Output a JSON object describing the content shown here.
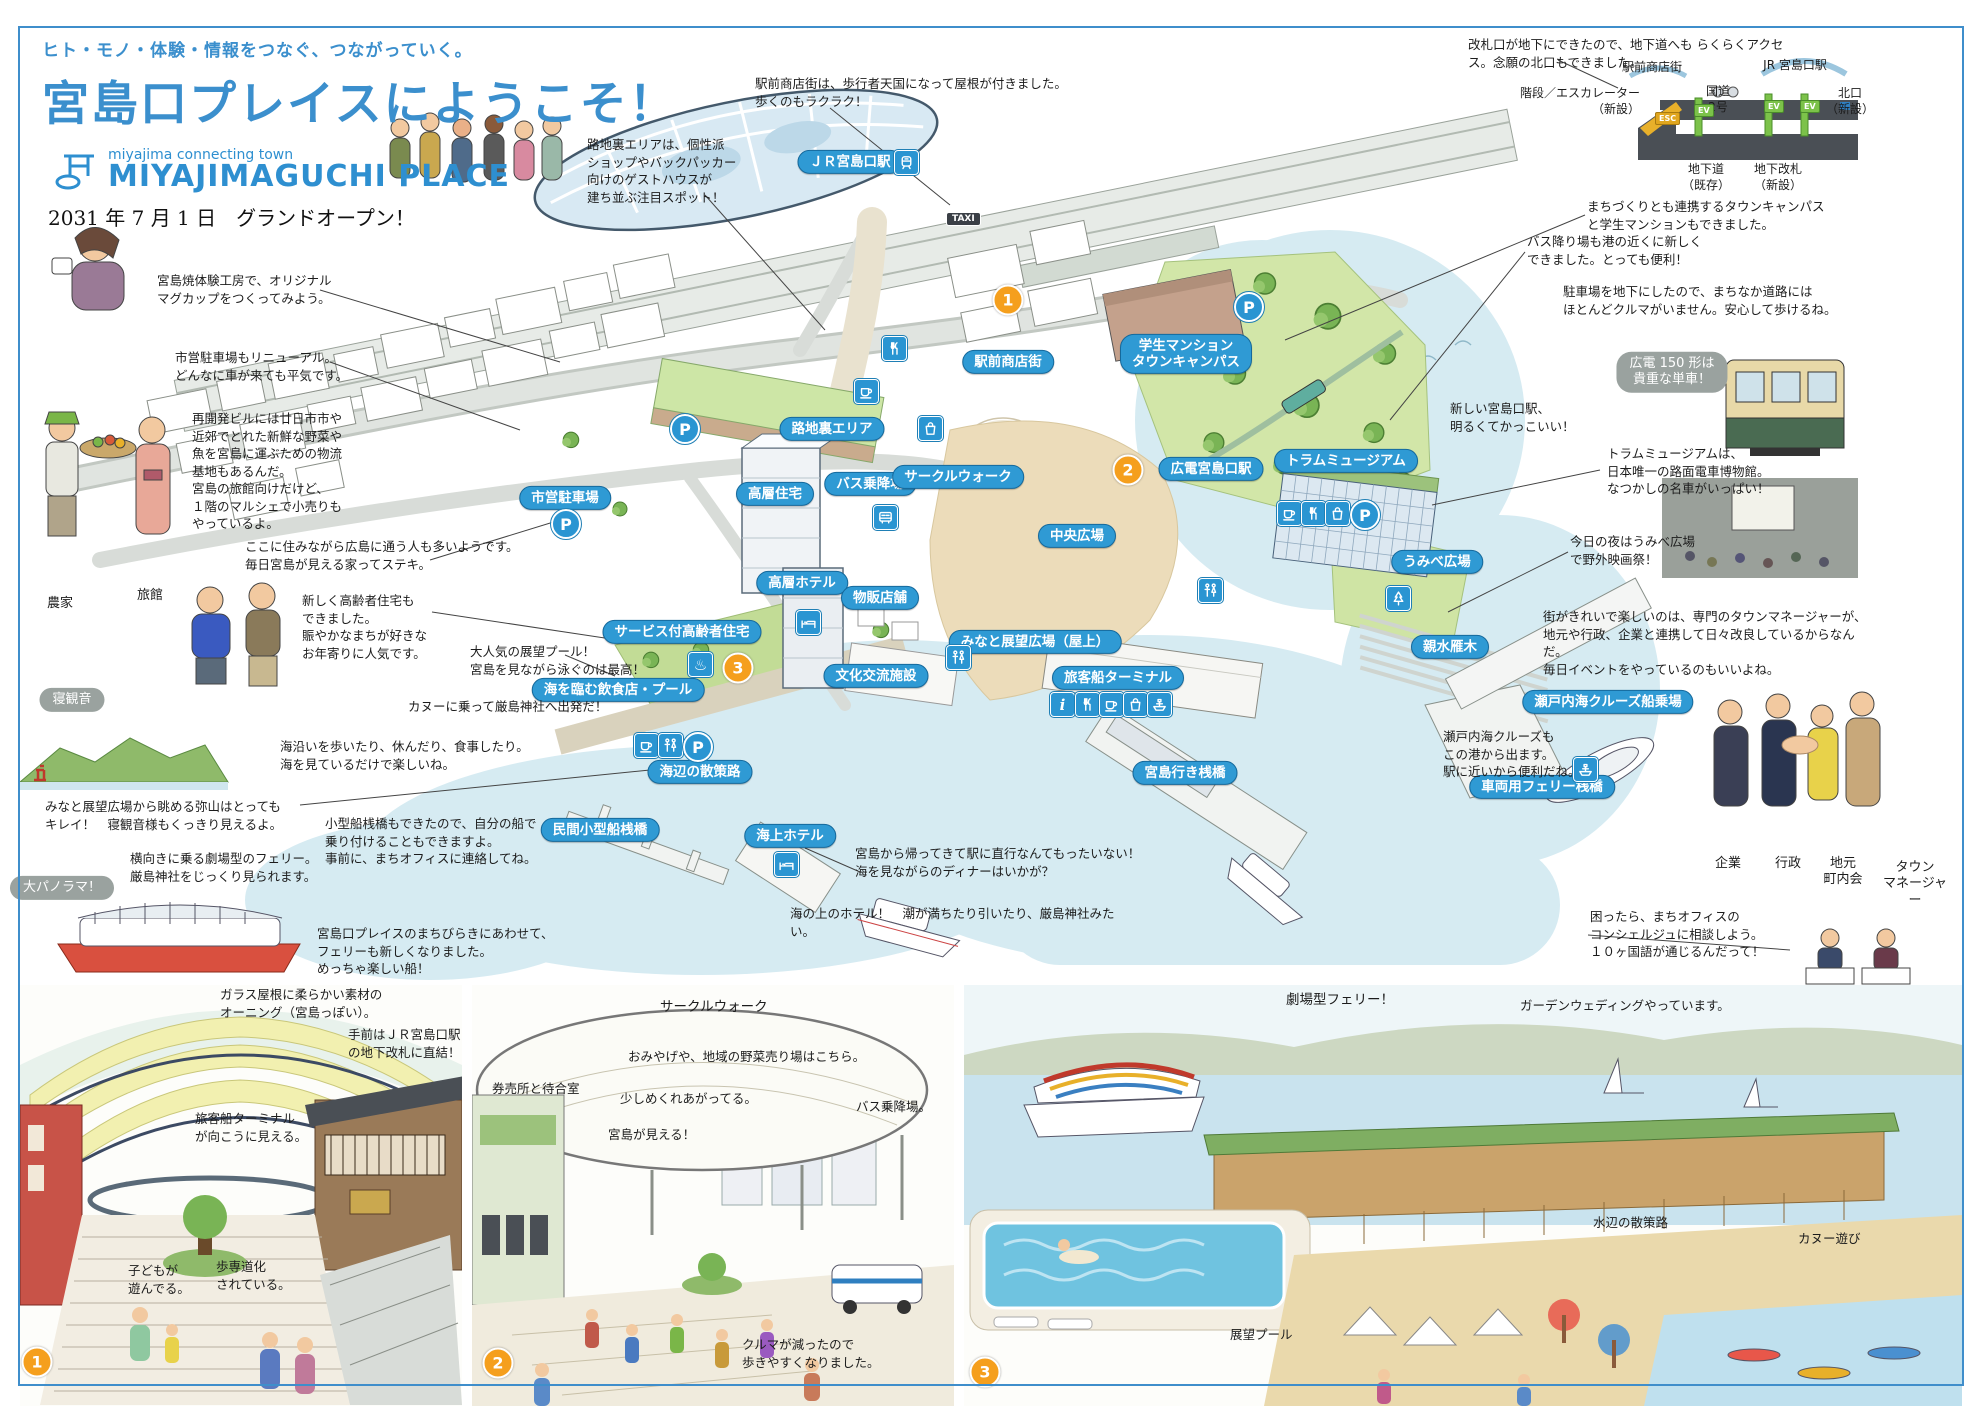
{
  "header": {
    "tagline": "ヒト・モノ・体験・情報をつなぐ、つながっていく。",
    "title": "宮島口プレイスにようこそ！",
    "logo_sub": "miyajima connecting town",
    "logo_main": "MIYAJIMAGUCHI PLACE",
    "open_date": "2031 年 7 月 1 日　グランドオープン！"
  },
  "colors": {
    "accent": "#3b8fcd",
    "pill": "#2f9ad4",
    "water": "#d6ebf2",
    "badge": "#f59f1d",
    "bubble": "#9aa29f"
  },
  "map": {
    "pills": [
      {
        "t": "ＪＲ宮島口駅",
        "x": 850,
        "y": 162
      },
      {
        "t": "駅前商店街",
        "x": 1008,
        "y": 362
      },
      {
        "t": "路地裏エリア",
        "x": 832,
        "y": 429
      },
      {
        "t": "市営駐車場",
        "x": 565,
        "y": 498
      },
      {
        "t": "バス乗降場",
        "x": 870,
        "y": 484
      },
      {
        "t": "サークルウォーク",
        "x": 958,
        "y": 477
      },
      {
        "t": "高層住宅",
        "x": 775,
        "y": 494
      },
      {
        "t": "高層ホテル",
        "x": 802,
        "y": 583
      },
      {
        "t": "物販店舗",
        "x": 880,
        "y": 598
      },
      {
        "t": "サービス付高齢者住宅",
        "x": 682,
        "y": 632
      },
      {
        "t": "文化交流施設",
        "x": 876,
        "y": 676
      },
      {
        "t": "みなと展望広場（屋上）",
        "x": 1035,
        "y": 642
      },
      {
        "t": "中央広場",
        "x": 1077,
        "y": 536
      },
      {
        "t": "広電宮島口駅",
        "x": 1211,
        "y": 469
      },
      {
        "t": "学生マンション\nタウンキャンパス",
        "x": 1186,
        "y": 354
      },
      {
        "t": "トラムミュージアム",
        "x": 1346,
        "y": 461
      },
      {
        "t": "うみべ広場",
        "x": 1437,
        "y": 562
      },
      {
        "t": "親水雁木",
        "x": 1450,
        "y": 647
      },
      {
        "t": "瀬戸内海クルーズ船乗場",
        "x": 1608,
        "y": 702
      },
      {
        "t": "車両用フェリー桟橋",
        "x": 1542,
        "y": 787
      },
      {
        "t": "旅客船ターミナル",
        "x": 1118,
        "y": 678
      },
      {
        "t": "宮島行き桟橋",
        "x": 1185,
        "y": 773
      },
      {
        "t": "民間小型船桟橋",
        "x": 600,
        "y": 830
      },
      {
        "t": "海上ホテル",
        "x": 790,
        "y": 836
      },
      {
        "t": "海辺の散策路",
        "x": 700,
        "y": 772
      },
      {
        "t": "海を臨む飲食店・プール",
        "x": 618,
        "y": 690
      }
    ],
    "badges": [
      {
        "t": "1",
        "x": 1008,
        "y": 300
      },
      {
        "t": "2",
        "x": 1128,
        "y": 470
      },
      {
        "t": "3",
        "x": 738,
        "y": 668
      }
    ],
    "callouts": [
      {
        "t": "駅前商店街は、歩行者天国になって屋根が付きました。\n歩くのもラクラク！",
        "x": 755,
        "y": 75
      },
      {
        "t": "路地裏エリアは、個性派\nショップやバックパッカー\n向けのゲストハウスが\n建ち並ぶ注目スポット！",
        "x": 587,
        "y": 136
      },
      {
        "t": "宮島焼体験工房で、オリジナル\nマグカップをつくってみよう。",
        "x": 157,
        "y": 272
      },
      {
        "t": "市営駐車場もリニューアル。\nどんなに車が来ても平気です。",
        "x": 175,
        "y": 349
      },
      {
        "t": "再開発ビルには廿日市市や\n近郊でとれた新鮮な野菜や\n魚を宮島に運ぶための物流\n基地もあるんだ。\n宮島の旅館向けだけど、\n１階のマルシェで小売りも\nやっているよ。",
        "x": 192,
        "y": 410
      },
      {
        "t": "ここに住みながら広島に通う人も多いようです。\n毎日宮島が見える家ってステキ。",
        "x": 245,
        "y": 538
      },
      {
        "t": "新しく高齢者住宅も\nできました。\n賑やかなまちが好きな\nお年寄りに人気です。",
        "x": 302,
        "y": 592
      },
      {
        "t": "大人気の展望プール！\n宮島を見ながら泳ぐのは最高！",
        "x": 470,
        "y": 643
      },
      {
        "t": "カヌーに乗って厳島神社へ出発だ！",
        "x": 408,
        "y": 698
      },
      {
        "t": "海沿いを歩いたり、休んだり、食事したり。\n海を見ているだけで楽しいね。",
        "x": 280,
        "y": 738
      },
      {
        "t": "みなと展望広場から眺める弥山はとっても\nキレイ！　寝観音様もくっきり見えるよ。",
        "x": 45,
        "y": 798
      },
      {
        "t": "小型船桟橋もできたので、自分の船で\n乗り付けることもできますよ。\n事前に、まちオフィスに連絡してね。",
        "x": 325,
        "y": 815
      },
      {
        "t": "横向きに乗る劇場型のフェリー。\n厳島神社をじっくり見られます。",
        "x": 130,
        "y": 850
      },
      {
        "t": "宮島口プレイスのまちびらきにあわせて、\nフェリーも新しくなりました。\nめっちゃ楽しい船！",
        "x": 317,
        "y": 925
      },
      {
        "t": "宮島から帰ってきて駅に直行なんてもったいない！\n海を見ながらのディナーはいかが？",
        "x": 855,
        "y": 845
      },
      {
        "t": "海の上のホテル！　潮が満ちたり引いたり、厳島神社みたい。",
        "x": 790,
        "y": 905
      },
      {
        "t": "改札口が地下にできたので、地下道へも らくらくアクセス。念願の北口もできました。",
        "x": 1468,
        "y": 36
      },
      {
        "t": "まちづくりとも連携するタウンキャンパス\nと学生マンションもできました。",
        "x": 1587,
        "y": 198
      },
      {
        "t": "バス降り場も港の近くに新しく\nできました。とっても便利！",
        "x": 1527,
        "y": 233
      },
      {
        "t": "駐車場を地下にしたので、まちなか道路には\nほとんどクルマがいません。安心して歩けるね。",
        "x": 1563,
        "y": 283
      },
      {
        "t": "新しい宮島口駅、\n明るくてかっこいい！",
        "x": 1450,
        "y": 400
      },
      {
        "t": "トラムミュージアムは、\n日本唯一の路面電車博物館。\nなつかしの名車がいっぱい！",
        "x": 1607,
        "y": 445
      },
      {
        "t": "今日の夜はうみべ広場\nで野外映画祭！",
        "x": 1570,
        "y": 533
      },
      {
        "t": "街がきれいで楽しいのは、専門のタウンマネージャーが、\n地元や行政、企業と連携して日々改良しているからなんだ。\n毎日イベントをやっているのもいいよね。",
        "x": 1543,
        "y": 608
      },
      {
        "t": "瀬戸内海クルーズも\nこの港から出ます。\n駅に近いから便利だね。",
        "x": 1443,
        "y": 728
      },
      {
        "t": "困ったら、まちオフィスの\nコンシェルジュに相談しよう。\n１０ヶ国語が通じるんだって！",
        "x": 1590,
        "y": 908
      }
    ],
    "bubbles": [
      {
        "t": "寝観音",
        "x": 72,
        "y": 700
      },
      {
        "t": "大パノラマ！",
        "x": 62,
        "y": 888
      },
      {
        "t": "広電 150 形は\n貴重な単車！",
        "x": 1672,
        "y": 372
      }
    ],
    "person_labels": [
      {
        "t": "農家",
        "x": 60,
        "y": 596
      },
      {
        "t": "旅館",
        "x": 150,
        "y": 588
      },
      {
        "t": "企業",
        "x": 1728,
        "y": 856
      },
      {
        "t": "行政",
        "x": 1788,
        "y": 856
      },
      {
        "t": "地元\n町内会",
        "x": 1843,
        "y": 856
      },
      {
        "t": "タウン\nマネージャー",
        "x": 1915,
        "y": 860
      }
    ],
    "icons": [
      {
        "g": "train",
        "x": 894,
        "y": 150
      },
      {
        "g": "taxi",
        "x": 946,
        "y": 212,
        "t": "TAXI"
      },
      {
        "g": "fork",
        "x": 882,
        "y": 336
      },
      {
        "g": "cup",
        "x": 854,
        "y": 379
      },
      {
        "g": "bag",
        "x": 918,
        "y": 416
      },
      {
        "g": "p",
        "x": 670,
        "y": 414
      },
      {
        "g": "p",
        "x": 551,
        "y": 509
      },
      {
        "g": "p",
        "x": 1234,
        "y": 292
      },
      {
        "g": "bus",
        "x": 873,
        "y": 505
      },
      {
        "g": "onsen",
        "x": 688,
        "y": 652,
        "t": "♨"
      },
      {
        "g": "bed",
        "x": 796,
        "y": 610
      },
      {
        "g": "wc",
        "x": 946,
        "y": 645
      },
      {
        "g": "wc",
        "x": 1198,
        "y": 578
      },
      {
        "g": "cup",
        "x": 1277,
        "y": 501
      },
      {
        "g": "fork",
        "x": 1301,
        "y": 501
      },
      {
        "g": "bag",
        "x": 1325,
        "y": 501
      },
      {
        "g": "p",
        "x": 1350,
        "y": 500
      },
      {
        "g": "tree",
        "x": 1386,
        "y": 586
      },
      {
        "g": "info",
        "x": 1050,
        "y": 692,
        "t": "i"
      },
      {
        "g": "fork",
        "x": 1075,
        "y": 692
      },
      {
        "g": "cup",
        "x": 1099,
        "y": 692
      },
      {
        "g": "bag",
        "x": 1123,
        "y": 692
      },
      {
        "g": "ship",
        "x": 1147,
        "y": 692
      },
      {
        "g": "ship",
        "x": 1573,
        "y": 757
      },
      {
        "g": "cup",
        "x": 634,
        "y": 733
      },
      {
        "g": "wc",
        "x": 658,
        "y": 733
      },
      {
        "g": "p",
        "x": 683,
        "y": 732
      },
      {
        "g": "bed",
        "x": 774,
        "y": 852
      }
    ]
  },
  "section_diagram": {
    "labels": [
      {
        "t": "駅前商店街",
        "x": 1652,
        "y": 60,
        "a": "c"
      },
      {
        "t": "国道\n2号",
        "x": 1718,
        "y": 84,
        "a": "c"
      },
      {
        "t": "JR 宮島口駅",
        "x": 1795,
        "y": 58,
        "a": "c"
      },
      {
        "t": "階段／エスカレーター\n（新設）",
        "x": 1640,
        "y": 86,
        "a": "r"
      },
      {
        "t": "北口\n（新設）",
        "x": 1850,
        "y": 86,
        "a": "c"
      },
      {
        "t": "地下道\n（既存）",
        "x": 1706,
        "y": 162,
        "a": "c"
      },
      {
        "t": "地下改札\n（新設）",
        "x": 1778,
        "y": 162,
        "a": "c"
      }
    ],
    "tags": [
      {
        "t": "ESC",
        "x": 1655,
        "y": 112,
        "cls": "esc"
      },
      {
        "t": "EV",
        "x": 1694,
        "y": 104,
        "cls": "ev"
      },
      {
        "t": "EV",
        "x": 1764,
        "y": 100,
        "cls": "ev"
      },
      {
        "t": "EV",
        "x": 1800,
        "y": 100,
        "cls": "ev"
      }
    ]
  },
  "panels": {
    "badges": [
      {
        "t": "1",
        "x": 37,
        "y": 1362
      },
      {
        "t": "2",
        "x": 498,
        "y": 1363
      },
      {
        "t": "3",
        "x": 985,
        "y": 1372
      }
    ],
    "texts": [
      {
        "t": "ガラス屋根に柔らかい素材の\nオーニング（宮島っぽい）。",
        "x": 220,
        "y": 986
      },
      {
        "t": "手前はＪＲ宮島口駅\nの地下改札に直結！",
        "x": 348,
        "y": 1026
      },
      {
        "t": "旅客船ターミナル\nが向こうに見える。",
        "x": 195,
        "y": 1110
      },
      {
        "t": "子どもが\n遊んでる。",
        "x": 128,
        "y": 1262
      },
      {
        "t": "歩専道化\nされている。",
        "x": 216,
        "y": 1258
      },
      {
        "t": "サークルウォーク",
        "x": 660,
        "y": 998,
        "cls": "big"
      },
      {
        "t": "券売所と待合室",
        "x": 492,
        "y": 1080
      },
      {
        "t": "おみやげや、地域の野菜売り場はこちら。",
        "x": 628,
        "y": 1048
      },
      {
        "t": "少しめくれあがってる。",
        "x": 620,
        "y": 1090
      },
      {
        "t": "宮島が見える！",
        "x": 608,
        "y": 1126
      },
      {
        "t": "バス乗降場。",
        "x": 856,
        "y": 1098
      },
      {
        "t": "クルマが減ったので\n歩きやすくなりました。",
        "x": 742,
        "y": 1336
      },
      {
        "t": "劇場型フェリー！",
        "x": 1286,
        "y": 991,
        "cls": "big"
      },
      {
        "t": "ガーデンウェディングやっています。",
        "x": 1520,
        "y": 997
      },
      {
        "t": "水辺の散策路",
        "x": 1593,
        "y": 1214
      },
      {
        "t": "カヌー遊び",
        "x": 1798,
        "y": 1230
      },
      {
        "t": "展望プール",
        "x": 1230,
        "y": 1326
      }
    ]
  }
}
